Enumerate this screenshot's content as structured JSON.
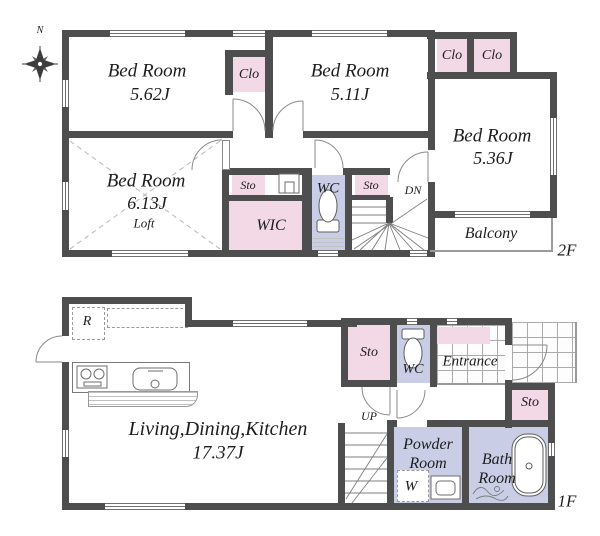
{
  "compass": {
    "north": "N"
  },
  "colors": {
    "wall": "#4e4e4e",
    "closet_pink": "#f3d9e6",
    "wet_area_lavender": "#c9cee6"
  },
  "f2": {
    "floor_label": "2F",
    "bedroom1": {
      "name": "Bed Room",
      "size": "5.62J"
    },
    "bedroom2": {
      "name": "Bed Room",
      "size": "5.11J"
    },
    "bedroom3": {
      "name": "Bed Room",
      "size": "5.36J"
    },
    "bedroom4": {
      "name": "Bed Room",
      "size": "6.13J",
      "loft": "Loft"
    },
    "closet1": "Clo",
    "closet2": "Clo",
    "closet3": "Clo",
    "storage1": "Sto",
    "storage2": "Sto",
    "wic": "WIC",
    "wc": "WC",
    "down": "DN",
    "balcony": "Balcony"
  },
  "f1": {
    "floor_label": "1F",
    "ldk": {
      "name": "Living,Dining,Kitchen",
      "size": "17.37J"
    },
    "refrigerator": "R",
    "storage1": "Sto",
    "storage2": "Sto",
    "wc": "WC",
    "entrance": "Entrance",
    "up": "UP",
    "powder_room": {
      "line1": "Powder",
      "line2": "Room"
    },
    "washer": "W",
    "bath_room": {
      "line1": "Bath",
      "line2": "Room"
    }
  }
}
